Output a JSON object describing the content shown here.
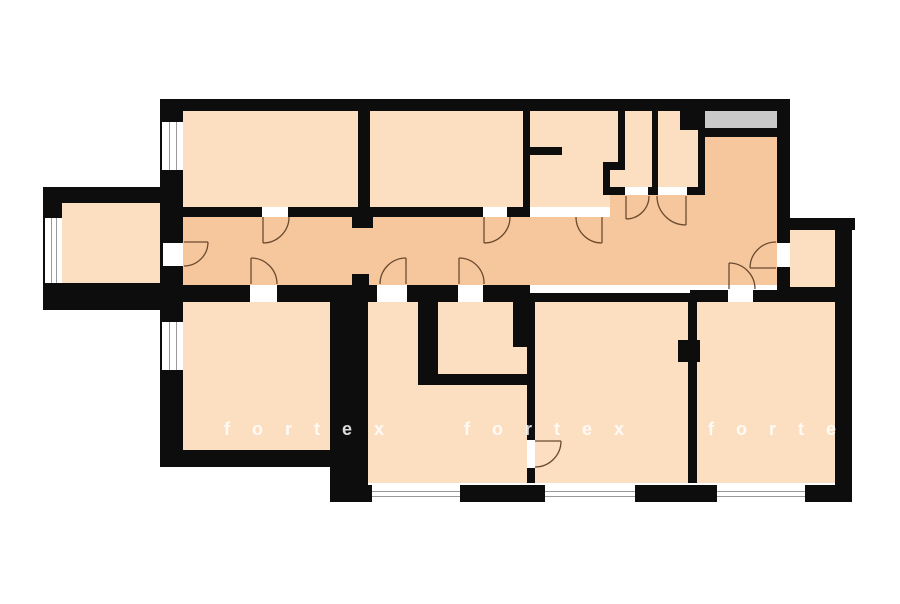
{
  "watermark": {
    "instances": [
      {
        "text": "fortex"
      },
      {
        "text": "fortex"
      },
      {
        "text": "forte"
      }
    ]
  },
  "palette": {
    "background": "#ffffff",
    "wall": "#0d0d0d",
    "room_fill": "#fcdfc1",
    "corridor_fill": "#f6c79d",
    "balcony_fill": "#c9c9c9",
    "window_line": "#9a9a9a",
    "door_arc": "#6b4a2f"
  },
  "plan": {
    "rooms": [
      {
        "name": "room-top-left",
        "fill": "room",
        "x": 183,
        "y": 108,
        "w": 175,
        "h": 99
      },
      {
        "name": "room-top-second",
        "fill": "room",
        "x": 370,
        "y": 108,
        "w": 153,
        "h": 99
      },
      {
        "name": "bathroom-top",
        "fill": "room",
        "x": 530,
        "y": 108,
        "w": 88,
        "h": 99
      },
      {
        "name": "toilet",
        "fill": "room",
        "x": 603,
        "y": 108,
        "w": 49,
        "h": 87
      },
      {
        "name": "storage-room",
        "fill": "room",
        "x": 658,
        "y": 108,
        "w": 40,
        "h": 79
      },
      {
        "name": "left-annex-room",
        "fill": "room",
        "x": 62,
        "y": 203,
        "w": 101,
        "h": 82
      },
      {
        "name": "right-annex-room",
        "fill": "room",
        "x": 790,
        "y": 230,
        "w": 45,
        "h": 57
      },
      {
        "name": "room-bottom-left",
        "fill": "room",
        "x": 183,
        "y": 302,
        "w": 147,
        "h": 148
      },
      {
        "name": "passage-bath-area",
        "fill": "room",
        "x": 360,
        "y": 302,
        "w": 167,
        "h": 181
      },
      {
        "name": "room-bottom-middle",
        "fill": "room",
        "x": 535,
        "y": 302,
        "w": 153,
        "h": 181
      },
      {
        "name": "room-bottom-right",
        "fill": "room",
        "x": 697,
        "y": 302,
        "w": 138,
        "h": 181
      },
      {
        "name": "corridor-main",
        "fill": "corridor",
        "x": 183,
        "y": 217,
        "w": 594,
        "h": 68
      },
      {
        "name": "corridor-upper-nook",
        "fill": "corridor",
        "x": 610,
        "y": 195,
        "w": 167,
        "h": 22
      },
      {
        "name": "entrance-hall",
        "fill": "corridor",
        "x": 705,
        "y": 137,
        "w": 72,
        "h": 148
      }
    ],
    "gray_areas": [
      {
        "name": "balcony-niche",
        "x": 705,
        "y": 111,
        "w": 72,
        "h": 17
      }
    ],
    "walls": [
      {
        "name": "wall-top-exterior",
        "x": 160,
        "y": 99,
        "w": 630,
        "h": 12
      },
      {
        "name": "wall-left-exterior",
        "x": 160,
        "y": 99,
        "w": 23,
        "h": 368
      },
      {
        "name": "wall-annex-top",
        "x": 43,
        "y": 187,
        "w": 120,
        "h": 16
      },
      {
        "name": "wall-annex-left",
        "x": 43,
        "y": 187,
        "w": 19,
        "h": 123
      },
      {
        "name": "wall-annex-bottom",
        "x": 43,
        "y": 283,
        "w": 140,
        "h": 27
      },
      {
        "name": "wall-corridor-top",
        "x": 183,
        "y": 207,
        "w": 347,
        "h": 10
      },
      {
        "name": "wall-divider-rooms12",
        "x": 358,
        "y": 108,
        "w": 12,
        "h": 99
      },
      {
        "name": "wall-arch-stub-top",
        "x": 352,
        "y": 217,
        "w": 21,
        "h": 11
      },
      {
        "name": "wall-arch-stub-bottom",
        "x": 352,
        "y": 274,
        "w": 17,
        "h": 12
      },
      {
        "name": "wall-divider-room2-bath",
        "x": 523,
        "y": 108,
        "w": 7,
        "h": 99
      },
      {
        "name": "wall-bath-stub",
        "x": 530,
        "y": 147,
        "w": 32,
        "h": 8
      },
      {
        "name": "wall-toilet-upper-left",
        "x": 618,
        "y": 108,
        "w": 7,
        "h": 55
      },
      {
        "name": "wall-toilet-jog",
        "x": 603,
        "y": 162,
        "w": 22,
        "h": 8
      },
      {
        "name": "wall-toilet-lower-left",
        "x": 603,
        "y": 162,
        "w": 7,
        "h": 33
      },
      {
        "name": "wall-toilet-storage-bottom",
        "x": 603,
        "y": 187,
        "w": 102,
        "h": 8
      },
      {
        "name": "wall-divider-toilet-storage",
        "x": 652,
        "y": 108,
        "w": 6,
        "h": 87
      },
      {
        "name": "wall-storage-right",
        "x": 698,
        "y": 108,
        "w": 7,
        "h": 87
      },
      {
        "name": "shaft-block",
        "x": 680,
        "y": 108,
        "w": 18,
        "h": 22
      },
      {
        "name": "wall-under-balcony",
        "x": 705,
        "y": 128,
        "w": 73,
        "h": 9
      },
      {
        "name": "wall-right-upper",
        "x": 777,
        "y": 99,
        "w": 13,
        "h": 188
      },
      {
        "name": "wall-right-annex-top",
        "x": 777,
        "y": 218,
        "w": 78,
        "h": 12
      },
      {
        "name": "wall-right-exterior",
        "x": 835,
        "y": 218,
        "w": 17,
        "h": 284
      },
      {
        "name": "wall-right-annex-bottom",
        "x": 777,
        "y": 287,
        "w": 58,
        "h": 15
      },
      {
        "name": "wall-corridor-bottom-a",
        "x": 160,
        "y": 285,
        "w": 370,
        "h": 17
      },
      {
        "name": "wall-corridor-bottom-b",
        "x": 530,
        "y": 293,
        "w": 160,
        "h": 9
      },
      {
        "name": "wall-corridor-bottom-c",
        "x": 690,
        "y": 290,
        "w": 145,
        "h": 12
      },
      {
        "name": "wall-thick-bottomleft",
        "x": 330,
        "y": 302,
        "w": 38,
        "h": 183
      },
      {
        "name": "wall-passage-right",
        "x": 418,
        "y": 302,
        "w": 20,
        "h": 80
      },
      {
        "name": "wall-bath2-bottom",
        "x": 418,
        "y": 374,
        "w": 110,
        "h": 11
      },
      {
        "name": "wall-bath2-stub",
        "x": 513,
        "y": 302,
        "w": 14,
        "h": 45
      },
      {
        "name": "wall-divider-passage-middle",
        "x": 527,
        "y": 302,
        "w": 8,
        "h": 181
      },
      {
        "name": "wall-divider-middle-right",
        "x": 688,
        "y": 302,
        "w": 9,
        "h": 181
      },
      {
        "name": "wall-stub-middle-right",
        "x": 678,
        "y": 340,
        "w": 22,
        "h": 22
      },
      {
        "name": "wall-bottom-exterior",
        "x": 330,
        "y": 485,
        "w": 522,
        "h": 17
      },
      {
        "name": "wall-bottomleft-room-bottom",
        "x": 163,
        "y": 450,
        "w": 167,
        "h": 17
      }
    ],
    "windows": [
      {
        "name": "window-left-upper",
        "x": 162,
        "y": 122,
        "w": 21,
        "h": 48,
        "orient": "v"
      },
      {
        "name": "window-left-lower",
        "x": 162,
        "y": 322,
        "w": 21,
        "h": 48,
        "orient": "v"
      },
      {
        "name": "window-annex-left",
        "x": 45,
        "y": 218,
        "w": 17,
        "h": 65,
        "orient": "v"
      },
      {
        "name": "window-bottom-1",
        "x": 372,
        "y": 485,
        "w": 88,
        "h": 17,
        "orient": "h"
      },
      {
        "name": "window-bottom-2",
        "x": 545,
        "y": 485,
        "w": 90,
        "h": 17,
        "orient": "h"
      },
      {
        "name": "window-bottom-3",
        "x": 717,
        "y": 485,
        "w": 88,
        "h": 17,
        "orient": "h"
      }
    ],
    "door_gaps": [
      {
        "name": "door-gap-annex",
        "x": 163,
        "y": 243,
        "w": 20,
        "h": 23
      },
      {
        "name": "door-gap-room1",
        "x": 262,
        "y": 207,
        "w": 26,
        "h": 10
      },
      {
        "name": "door-gap-room2",
        "x": 483,
        "y": 207,
        "w": 24,
        "h": 10
      },
      {
        "name": "door-gap-bath-top",
        "x": 580,
        "y": 207,
        "w": 22,
        "h": 10
      },
      {
        "name": "door-gap-toilet",
        "x": 625,
        "y": 187,
        "w": 23,
        "h": 8
      },
      {
        "name": "door-gap-storage",
        "x": 658,
        "y": 187,
        "w": 29,
        "h": 8
      },
      {
        "name": "door-gap-right-annex",
        "x": 777,
        "y": 243,
        "w": 13,
        "h": 24
      },
      {
        "name": "door-gap-bottom-left",
        "x": 250,
        "y": 285,
        "w": 27,
        "h": 17
      },
      {
        "name": "door-gap-passage",
        "x": 377,
        "y": 285,
        "w": 30,
        "h": 17
      },
      {
        "name": "door-gap-bath2",
        "x": 458,
        "y": 285,
        "w": 25,
        "h": 17
      },
      {
        "name": "door-gap-bottom-right",
        "x": 728,
        "y": 290,
        "w": 25,
        "h": 12
      },
      {
        "name": "door-gap-middle-room",
        "x": 527,
        "y": 440,
        "w": 8,
        "h": 28
      }
    ],
    "door_arcs": [
      {
        "name": "arc-annex",
        "leaf": "M184,242 L208,242",
        "arc": "M208,242 A24,24 0 0 1 184,266"
      },
      {
        "name": "arc-room1",
        "leaf": "M263,217 L263,243",
        "arc": "M263,243 A26,26 0 0 0 289,217"
      },
      {
        "name": "arc-room2",
        "leaf": "M484,217 L484,243",
        "arc": "M484,243 A26,26 0 0 0 510,217"
      },
      {
        "name": "arc-bath-top",
        "leaf": "M602,217 L602,243",
        "arc": "M602,243 A26,26 0 0 1 576,217"
      },
      {
        "name": "arc-toilet",
        "leaf": "M626,196 L626,219",
        "arc": "M626,219 A23,23 0 0 0 649,196"
      },
      {
        "name": "arc-storage",
        "leaf": "M686,196 L686,225",
        "arc": "M686,225 A29,29 0 0 1 657,196"
      },
      {
        "name": "arc-right-annex",
        "leaf": "M776,268 L750,268",
        "arc": "M750,268 A26,26 0 0 1 776,242"
      },
      {
        "name": "arc-bottom-left",
        "leaf": "M251,284 L251,258",
        "arc": "M251,258 A26,26 0 0 1 277,284"
      },
      {
        "name": "arc-passage",
        "leaf": "M406,284 L406,258",
        "arc": "M406,258 A26,26 0 0 0 380,284"
      },
      {
        "name": "arc-bath2",
        "leaf": "M459,284 L459,258",
        "arc": "M459,258 A25,25 0 0 1 484,284"
      },
      {
        "name": "arc-bottom-right",
        "leaf": "M729,289 L729,263",
        "arc": "M729,263 A26,26 0 0 1 755,289"
      },
      {
        "name": "arc-middle-room",
        "leaf": "M535,441 L561,441",
        "arc": "M561,441 A26,26 0 0 1 535,467"
      }
    ]
  }
}
